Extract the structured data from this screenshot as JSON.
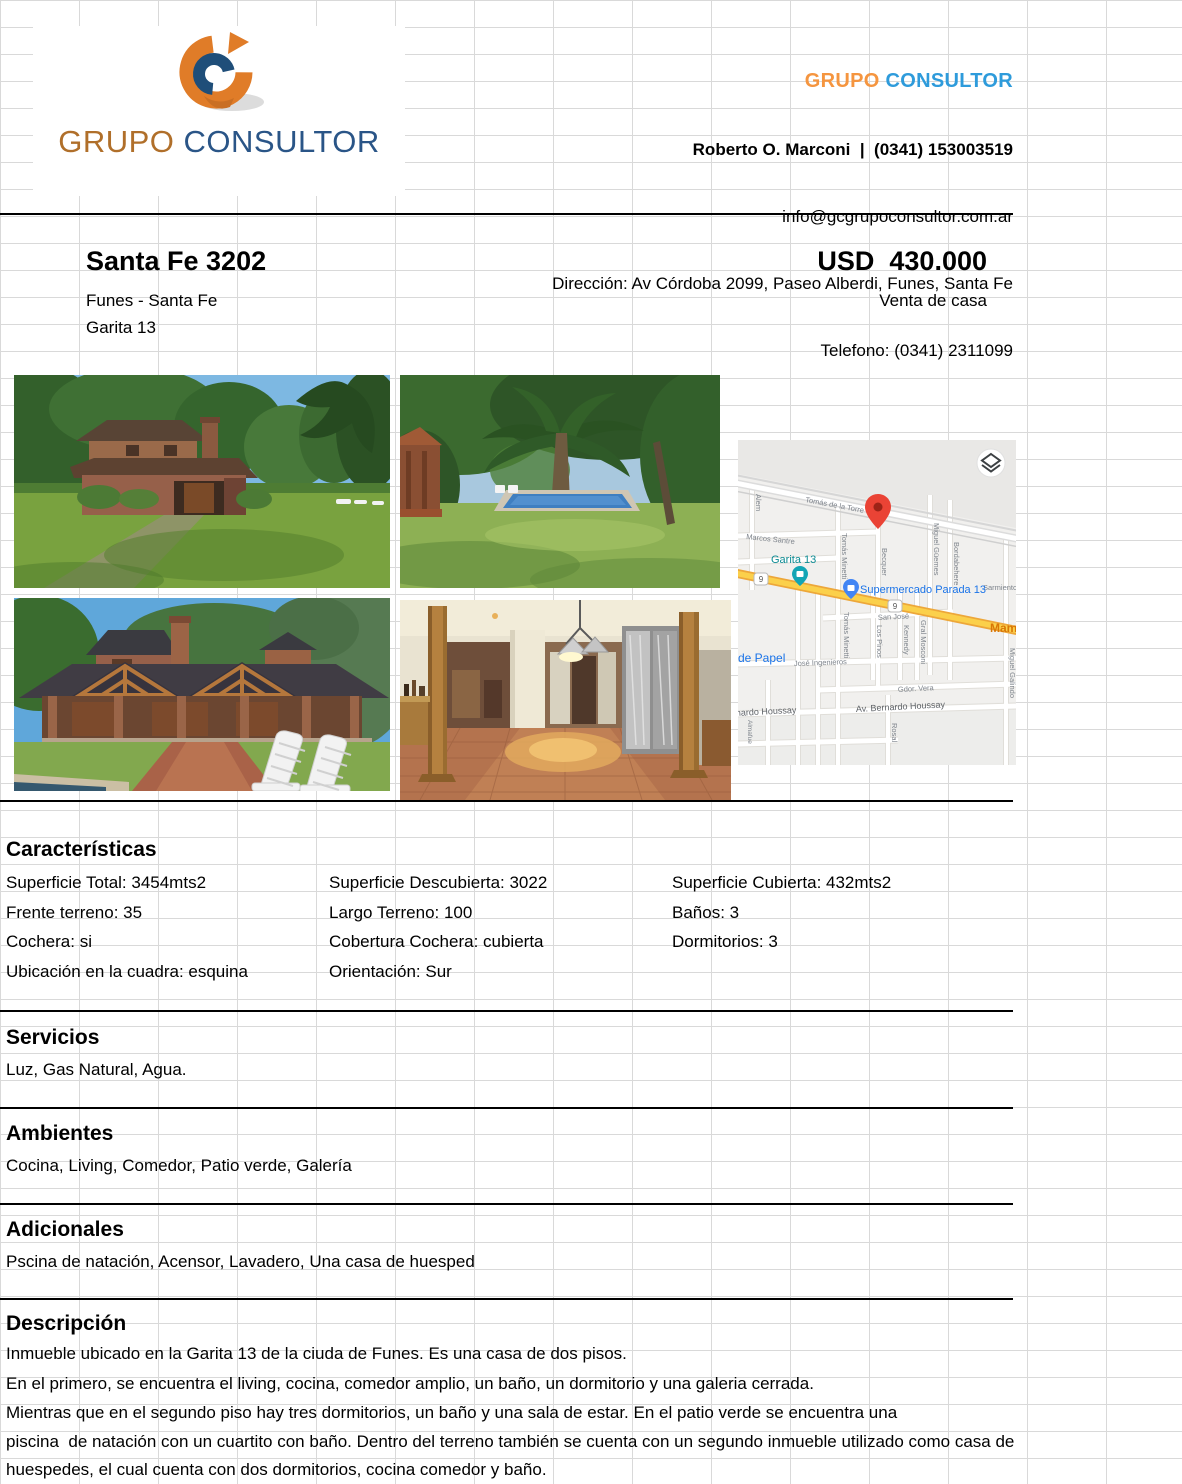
{
  "header": {
    "brand": {
      "grupo": "GRUPO",
      "consultor": "CONSULTOR"
    },
    "agent_line": "Roberto O. Marconi  |  (0341) 153003519",
    "email": "info@gcgrupoconsultor.com.ar",
    "address_line": "Dirección: Av Córdoba 2099, Paseo Alberdi, Funes, Santa Fe",
    "phone_line": "Telefono: (0341) 2311099",
    "colors": {
      "orange": "#f5953f",
      "blue": "#2e9bdb"
    }
  },
  "logo": {
    "grupo": "GRUPO",
    "consultor": "CONSULTOR",
    "colors": {
      "grupo": "#b06f2a",
      "consultor": "#2a5587",
      "mark_orange": "#e07c28",
      "mark_blue": "#1f4e79"
    }
  },
  "listing": {
    "title": "Santa Fe 3202",
    "location": "Funes - Santa Fe",
    "neighborhood": "Garita 13",
    "price": "USD  430.000",
    "operation": "Venta de casa"
  },
  "photos": [
    {
      "name": "exterior-front-lawn"
    },
    {
      "name": "garden-pool-palms"
    },
    {
      "name": "exterior-porch-chairs"
    },
    {
      "name": "interior-hall-columns"
    }
  ],
  "map": {
    "route_badge": "9",
    "labels": {
      "tomas_de_la_torre": "Tomás de la Torre",
      "marcos_santre": "Marcos Santre",
      "alem": "Alem",
      "tomas_minetti": "Tomás Minetti",
      "becquer": "Becquer",
      "miguel_guemes": "Miguel Güemes",
      "bordabehere": "Bordabehere",
      "sarmiento": "Sarmiento",
      "san_jose": "San José",
      "los_pinos": "Los Pinos",
      "kennedy": "Kennedy",
      "gral_mosconi": "Gral Mosconi",
      "jose_ingenieros": "José Ingenieros",
      "gdor_vera": "Gdor. Vera",
      "av_bernardo_houssay": "Av. Bernardo Houssay",
      "nardo_houssay": "nardo Houssay",
      "rosal": "Rosal",
      "miguel_galindo": "Miguel Galindo",
      "almafue": "Almafue",
      "mami": "Mami",
      "de_papel": "de Papel",
      "garita_13": "Garita 13",
      "supermercado": "Supermercado Parada 13"
    },
    "colors": {
      "poi_blue": "#1a73e8",
      "poi_teal": "#0c8b93",
      "route_yellow": "#fbd04b",
      "pin_red": "#ea4335"
    }
  },
  "sections": {
    "caracteristicas": {
      "title": "Características",
      "col1": [
        "Superficie Total: 3454mts2",
        "Frente terreno: 35",
        "Cochera: si",
        "Ubicación en la cuadra: esquina"
      ],
      "col2": [
        "Superficie Descubierta: 3022",
        "Largo Terreno: 100",
        "Cobertura Cochera: cubierta",
        "Orientación: Sur"
      ],
      "col3": [
        "Superficie Cubierta: 432mts2",
        "Baños: 3",
        "Dormitorios: 3"
      ]
    },
    "servicios": {
      "title": "Servicios",
      "text": "Luz, Gas Natural, Agua."
    },
    "ambientes": {
      "title": "Ambientes",
      "text": "Cocina, Living, Comedor, Patio verde, Galería"
    },
    "adicionales": {
      "title": "Adicionales",
      "text": "Pscina de natación, Acensor, Lavadero, Una casa de huesped"
    },
    "descripcion": {
      "title": "Descripción",
      "lines": [
        "Inmueble ubicado en la Garita 13 de la ciuda de Funes. Es una casa de dos pisos.",
        "En el primero, se encuentra el living, cocina, comedor amplio, un baño, un dormitorio y una galeria cerrada.",
        "Mientras que en el segundo piso hay tres dormitorios, un baño y una sala de estar. En el patio verde se encuentra una",
        "piscina  de natación con un cuartito con baño. Dentro del terreno también se cuenta con un segundo inmueble utilizado como casa de",
        "huespedes, el cual cuenta con dos dormitorios, cocina comedor y baño."
      ]
    }
  }
}
